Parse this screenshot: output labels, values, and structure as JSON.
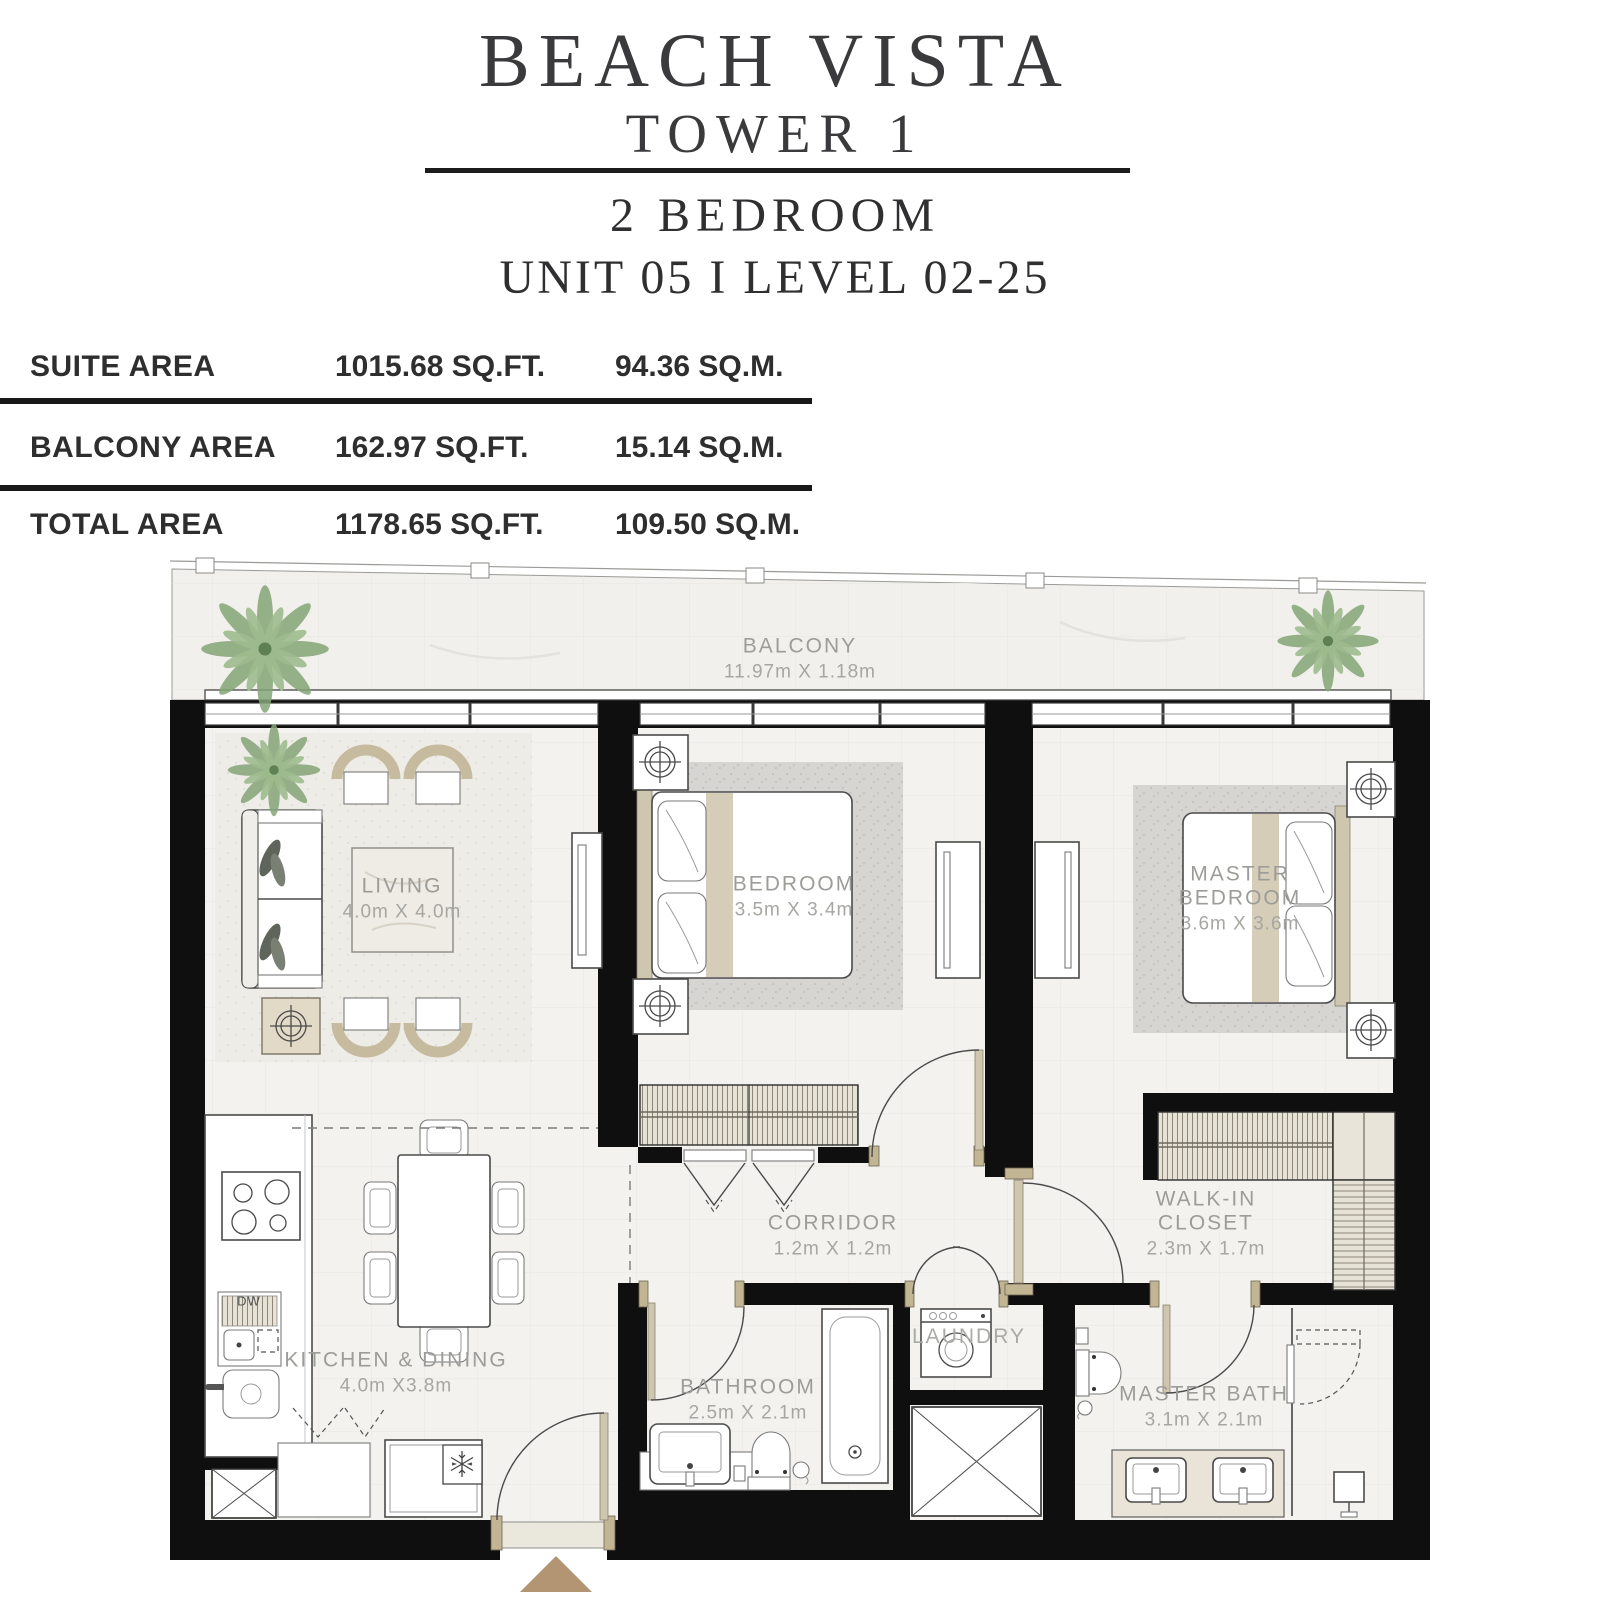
{
  "header": {
    "project": "BEACH VISTA",
    "tower": "TOWER 1",
    "unit_type": "2  BEDROOM",
    "unit_line": "UNIT 05  I  LEVEL 02-25"
  },
  "area_table": {
    "rows": [
      {
        "label": "SUITE AREA",
        "sqft": "1015.68 SQ.FT.",
        "sqm": "94.36 SQ.M."
      },
      {
        "label": "BALCONY AREA",
        "sqft": "162.97 SQ.FT.",
        "sqm": "15.14 SQ.M."
      },
      {
        "label": "TOTAL AREA",
        "sqft": "1178.65 SQ.FT.",
        "sqm": "109.50 SQ.M."
      }
    ]
  },
  "floorplan": {
    "balcony": {
      "name": "BALCONY",
      "dims": "11.97m X 1.18m"
    },
    "living": {
      "name": "LIVING",
      "dims": "4.0m X 4.0m"
    },
    "bedroom": {
      "name": "BEDROOM",
      "dims": "3.5m X 3.4m"
    },
    "master_bedroom": {
      "name": "MASTER BEDROOM",
      "dims": "3.6m X 3.6m"
    },
    "kitchen_dining": {
      "name": "KITCHEN & DINING",
      "dims": "4.0m X3.8m"
    },
    "corridor": {
      "name": "CORRIDOR",
      "dims": "1.2m X 1.2m"
    },
    "bathroom": {
      "name": "BATHROOM",
      "dims": "2.5m X 2.1m"
    },
    "laundry": {
      "name": "LAUNDRY"
    },
    "walk_in_closet": {
      "name": "WALK-IN CLOSET",
      "dims": "2.3m X 1.7m"
    },
    "master_bath": {
      "name": "MASTER BATH",
      "dims": "3.1m X 2.1m"
    },
    "labels": {
      "dishwasher": "DW"
    }
  },
  "colors": {
    "wall": "#0f0f0f",
    "accent_tan": "#b39574",
    "label_gray": "#9c9c98"
  }
}
